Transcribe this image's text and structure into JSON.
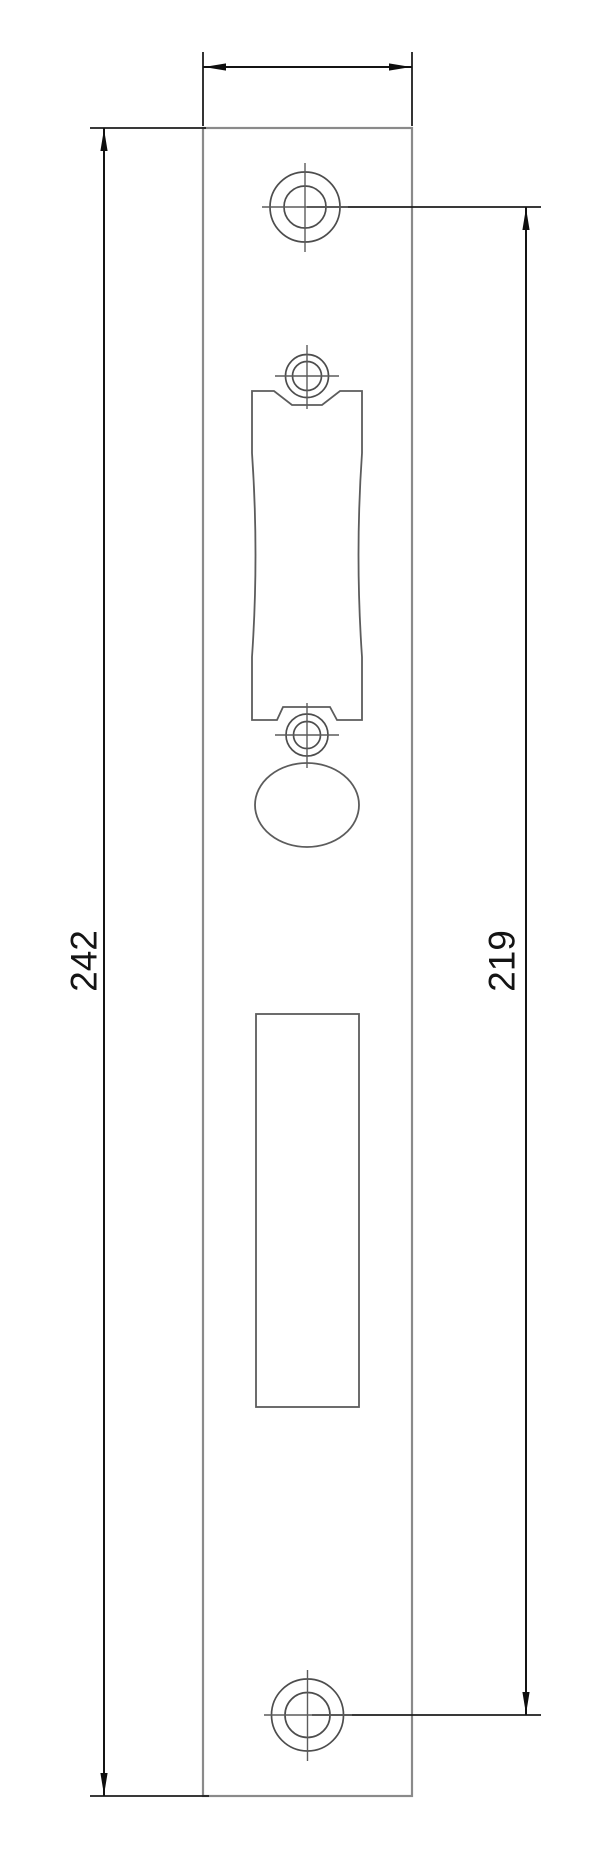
{
  "drawing": {
    "type": "technical-drawing",
    "subject": "strike-plate-front-view",
    "dimension_labels": {
      "overall_height": "242",
      "hole_spacing": "219",
      "width": ""
    }
  },
  "colors": {
    "background": "#ffffff",
    "dimension_lines": "#141414",
    "plate_outline": "#8a8a8a",
    "feature_outline": "#5c5c5c"
  }
}
